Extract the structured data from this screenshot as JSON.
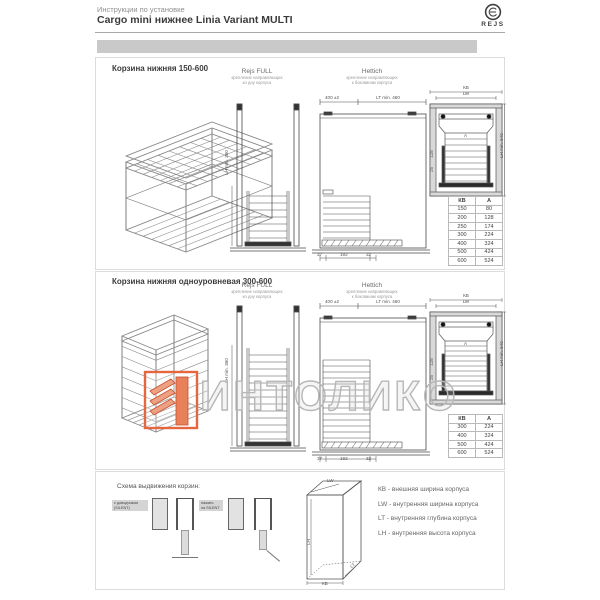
{
  "header": {
    "eyebrow": "Инструкции по установке",
    "title": "Cargo mini нижнее Linia Variant MULTI",
    "brand": "REJS"
  },
  "sections": {
    "s1_title": "Корзина нижняя 150-600",
    "s2_title": "Корзина нижняя одноуровневая 300-600",
    "s3_title": "Схема выдвижения корзин:"
  },
  "columns": {
    "rejs": {
      "name": "Rejs FULL",
      "sub1": "крепление направляющих",
      "sub2": "ко дну корпуса"
    },
    "hettich": {
      "name": "Hettich",
      "sub1": "крепление направляющих",
      "sub2": "к боковинам корпуса"
    }
  },
  "dims": {
    "width_tol": "400 ±2",
    "depth_min": "LT min. 460",
    "kb": "КВ",
    "lw": "LW",
    "a": "A",
    "lh_right": "LH min. 540",
    "lh_mid": "LH min. 380",
    "bottom1": "37",
    "bottom2": "192",
    "bottom3": "32",
    "side_small1": "128",
    "side_small2": "25"
  },
  "tables": {
    "headers": [
      "КВ",
      "А"
    ],
    "s1_rows": [
      [
        "150",
        "80"
      ],
      [
        "200",
        "128"
      ],
      [
        "250",
        "174"
      ],
      [
        "300",
        "224"
      ],
      [
        "400",
        "324"
      ],
      [
        "500",
        "424"
      ],
      [
        "600",
        "524"
      ]
    ],
    "s2_rows": [
      [
        "300",
        "224"
      ],
      [
        "400",
        "324"
      ],
      [
        "500",
        "424"
      ],
      [
        "600",
        "524"
      ]
    ]
  },
  "scheme": {
    "label1_l1": "с доводчиком",
    "label1_l2": "(SILENT)",
    "label2_l1": "нажать",
    "label2_l2": "на SILENT"
  },
  "cabinet": {
    "lw": "LW",
    "lh": "LH",
    "lt": "LT",
    "kb": "КВ"
  },
  "legend": [
    "КВ - внешняя ширина корпуса",
    "LW - внутренняя ширина корпуса",
    "LT - внутренняя глубина корпуса",
    "LH - внутренняя высота корпуса"
  ],
  "watermark": {
    "text": "ИНТОЛИКО"
  },
  "colors": {
    "accent": "#e4673f",
    "bar": "#c9c9c9"
  }
}
